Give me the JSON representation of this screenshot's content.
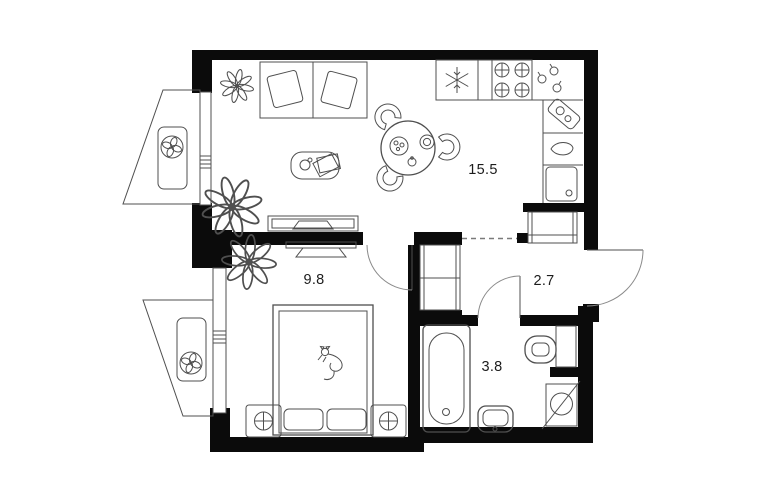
{
  "meta": {
    "type": "apartment-floor-plan"
  },
  "colors": {
    "background": "#ffffff",
    "walls": "#0b0b0b",
    "lines": "#4f4f4f",
    "text": "#1c1c1c"
  },
  "rooms": [
    {
      "name": "living-room-kitchen",
      "area_label": "15.5"
    },
    {
      "name": "bedroom",
      "area_label": "9.8"
    },
    {
      "name": "hallway",
      "area_label": "2.7"
    },
    {
      "name": "bathroom",
      "area_label": "3.8"
    }
  ],
  "symbols": [
    "fridge-snowflake-icon",
    "stove-burners-icon",
    "kitchen-sink-icon",
    "kitchen-basin-icon",
    "cutting-board-icon",
    "sofa",
    "pillow",
    "plant-icon",
    "coffee-table",
    "dining-table",
    "chair",
    "tv-console",
    "tv",
    "bed",
    "cat-icon",
    "nightstand-lamp-icon",
    "wardrobe",
    "hallway-closet",
    "bathtub",
    "toilet",
    "washbasin",
    "washing-machine-icon",
    "air-conditioner-fan-icon",
    "balcony",
    "window",
    "door-swing",
    "shaft"
  ]
}
